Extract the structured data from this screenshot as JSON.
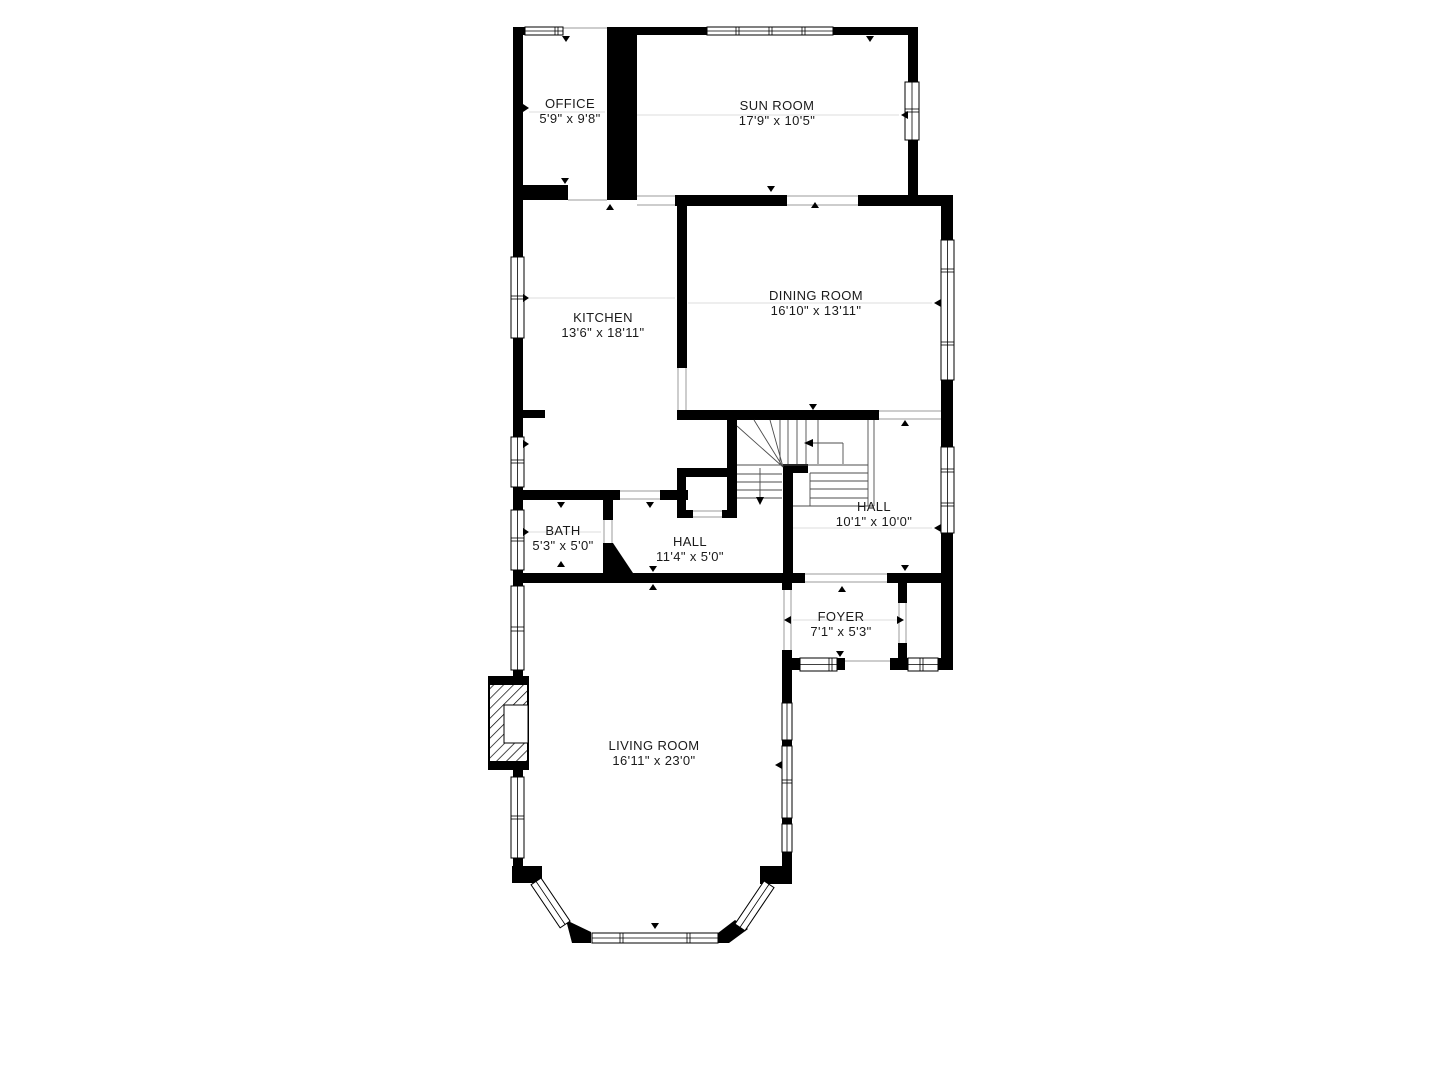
{
  "colors": {
    "wall": "#000000",
    "background": "#ffffff",
    "label_text": "#1a1a1a"
  },
  "rooms": [
    {
      "id": "office",
      "name": "OFFICE",
      "dims": "5'9\" x 9'8\""
    },
    {
      "id": "sun-room",
      "name": "SUN ROOM",
      "dims": "17'9\" x 10'5\""
    },
    {
      "id": "kitchen",
      "name": "KITCHEN",
      "dims": "13'6\" x 18'11\""
    },
    {
      "id": "dining-room",
      "name": "DINING ROOM",
      "dims": "16'10\" x 13'11\""
    },
    {
      "id": "hall-upper",
      "name": "HALL",
      "dims": "10'1\" x 10'0\""
    },
    {
      "id": "bath",
      "name": "BATH",
      "dims": "5'3\" x 5'0\""
    },
    {
      "id": "hall-lower",
      "name": "HALL",
      "dims": "11'4\" x 5'0\""
    },
    {
      "id": "foyer",
      "name": "FOYER",
      "dims": "7'1\" x 5'3\""
    },
    {
      "id": "living-room",
      "name": "LIVING ROOM",
      "dims": "16'11\" x 23'0\""
    }
  ]
}
